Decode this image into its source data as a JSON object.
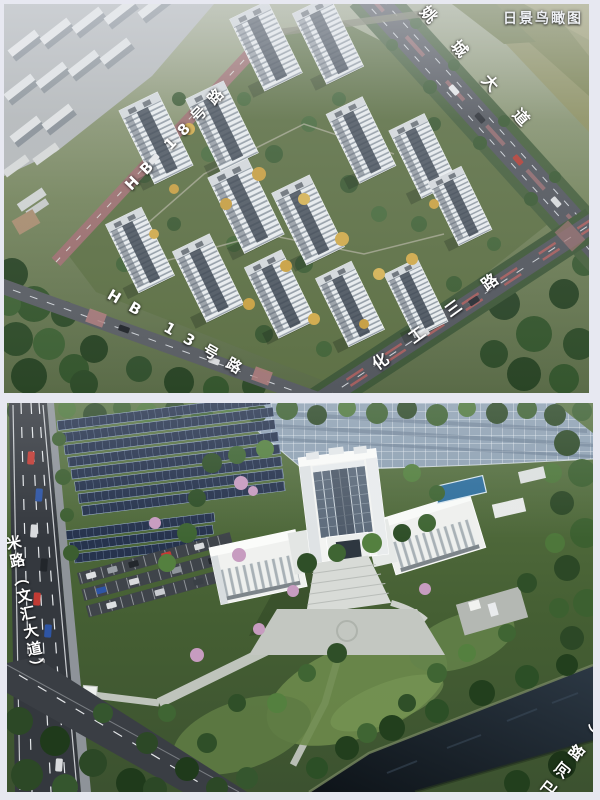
{
  "page": {
    "background": "#e7e8f1"
  },
  "top_image": {
    "watermark": "日景鸟瞰图",
    "labels": {
      "road_hb18": "HB 18号路",
      "road_hb13": "HB 13号路",
      "road_huagong": "化工三路",
      "road_yaocheng": "姚城大道"
    }
  },
  "bottom_image": {
    "labels": {
      "road_wenhui": "米路（文汇大道）",
      "road_weihe": "卫河路（"
    }
  },
  "colors": {
    "background": "#e7e8f1",
    "label_text": "#ffffff",
    "solar_panel_blue": "#26334d",
    "solar_field_gray": "#8ea1b3",
    "building_white": "#f3f4f2",
    "grass_green": "#55713f",
    "forest_green": "#2f4c2a",
    "water_dark": "#10161c",
    "pink_pavement": "#9b6f6f",
    "blossom_pink": "#c79cc0",
    "asphalt": "#34383e"
  }
}
